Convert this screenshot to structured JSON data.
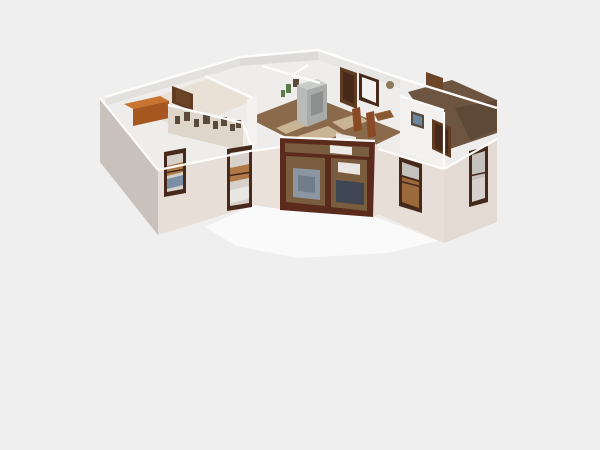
{
  "app": {
    "title": "3D Floor Plan Render",
    "description": "Aerial dollhouse 3D render of a single-story chevron-shaped house with two angled wings, open-top white walls, furnished interior and a dark-wood glazed entrance at the center front, on a plain light gray background."
  },
  "view": {
    "type": "3d-dollhouse-render",
    "background": "#efefef"
  },
  "colors": {
    "background": "#efefef",
    "terrace": "#fbfafa",
    "shell_white": "#eeedeb",
    "band1": "#e2e1df",
    "band2": "#dcdbd9",
    "band3": "#e7e6e4",
    "wall_top": "#fcfcfb",
    "wall_front": "#e8ded8",
    "wall_front_light": "#ebe1db",
    "wall_front_dark": "#e4dad4",
    "wall_side": "#c9c1bb",
    "inner_cream": "#ded6ca",
    "inner_white": "#f2f1ef",
    "glass_bright": "#f3f2f0",
    "floor_cream": "#e9e1d5",
    "wood": "#8a6a4b",
    "wood_light": "#c9b493",
    "carpet": "#6d5541",
    "carpet_dark": "#5e4836",
    "frame_dark": "#46291a",
    "frame_brown": "#5f3b22",
    "door_brown": "#6b4526",
    "glass_light": "#d6d1ca",
    "glass_gray": "#c5c2be",
    "entrance_frame": "#5a2a1d",
    "entrance_interior": "#7a5c3e",
    "rug_blue": "#8c96a2",
    "rug_blue_dark": "#727d8b",
    "sofa_navy": "#3e4654",
    "bedding": "#e9e7e3",
    "fridge_top": "#cbcdcb",
    "fridge_light": "#b9bbb9",
    "fridge_dark": "#a9abaa",
    "fridge_panel": "#8d8f8e",
    "cabinet_top": "#c8732f",
    "cabinet_front": "#a5571f",
    "chair": "#8a4a26",
    "table": "#8a5a32",
    "plant": "#5a7a4a",
    "art_frame": "#5a4a3c",
    "art_blue": "#6a86a0",
    "wreath": "#8a7a5a",
    "lamp": "#eceae6",
    "win_orange": "#b07a48",
    "win_scene_brown": "#9a6a3c",
    "win_blue": "#7a8fa6"
  },
  "scene_objects": {
    "left_wing": "bedroom with orange dresser, hallway with gallery picture wall, two dark-framed front windows",
    "center": "kitchen-dining room with gray refrigerator, dining chairs and table, glazed dark-wood entrance",
    "right_wing": "two carpeted rooms, room with blue wall art and wood doors, two dark-framed front windows"
  }
}
